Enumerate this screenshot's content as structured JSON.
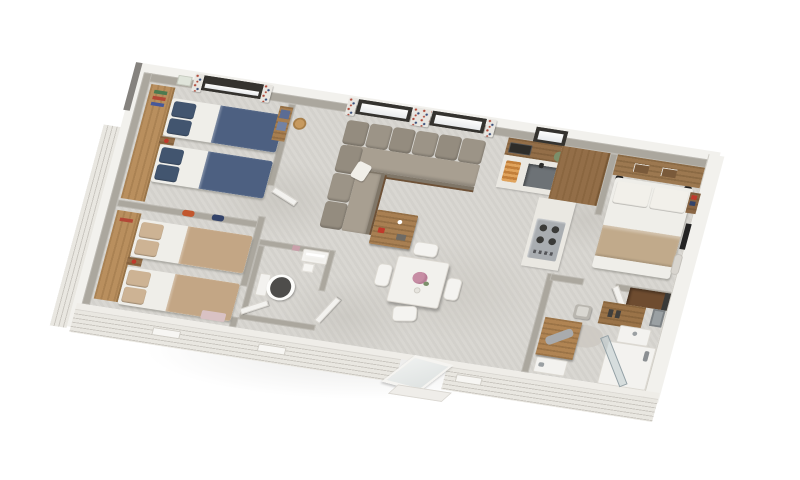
{
  "scene": {
    "kind": "3d-isometric-floor-plan-render",
    "subject": "mobile-home / holiday-home interior, three bedrooms",
    "background": "#ffffff",
    "visible_text": "none"
  },
  "palette": {
    "bg": "#ffffff",
    "floor": "#d7d5d0",
    "wall": "#aba79e",
    "fascia": "#f2f1ed",
    "siding_light": "#e9e7e1",
    "siding_dark": "#c9c6bf",
    "wood_light": "#b98f5e",
    "wood_mid": "#936e48",
    "wood_dark": "#6e4c30",
    "sofa_cushion": "#948c7f",
    "sofa_seat": "#a89f91",
    "navy": "#4d6081",
    "navy_dark": "#42556f",
    "sheet": "#efeee9",
    "tan": "#c3a685",
    "tan_light": "#cdb394",
    "throw": "#c1aa8b",
    "counter": "#eae8e2",
    "sink": "#6d7276",
    "cooktop": "#a9adb1",
    "whitefurn": "#f3f2ef",
    "frame_dark": "#35332f",
    "curtain": "#e8e6e1",
    "accent_red": "#c0392b",
    "accent_orange": "#c2572e",
    "accent_navy": "#33436a",
    "flower": "#c78da4",
    "leaf": "#7b8f6a",
    "seat_dark": "#4e4d4b",
    "glass": "#b9c7cc",
    "rug": "#ccc9c2"
  },
  "building": {
    "exterior": [
      "white-clapboard-siding",
      "vent-grilles-x3",
      "open-glazed-entrance-door",
      "entry-step"
    ],
    "rooms": [
      {
        "name": "bedroom-twin-1",
        "position": "top-left",
        "furniture": [
          "wardrobe",
          "twin-bed-navy",
          "twin-bed-navy",
          "nightstand",
          "window-with-blind",
          "floral-curtain",
          "wall-art",
          "shelf-with-blue-boxes"
        ]
      },
      {
        "name": "bedroom-twin-2",
        "position": "bottom-left",
        "furniture": [
          "wardrobe",
          "twin-bed-tan",
          "twin-bed-tan",
          "nightstand",
          "storage-box-pink"
        ]
      },
      {
        "name": "wc",
        "position": "center-left",
        "furniture": [
          "toilet",
          "towel-shelf",
          "wall-art"
        ]
      },
      {
        "name": "hallway",
        "position": "center",
        "furniture": [
          "pendant-lamp",
          "open-doors"
        ]
      },
      {
        "name": "living-room",
        "position": "center-top",
        "furniture": [
          "corner-sofa-taupe",
          "white-throw-pillow",
          "coffee-table",
          "window",
          "window",
          "floral-curtains"
        ]
      },
      {
        "name": "dining-area",
        "position": "center",
        "furniture": [
          "square-white-table",
          "chair",
          "chair",
          "chair",
          "chair",
          "pink-flower-vase"
        ]
      },
      {
        "name": "kitchen",
        "position": "center-right",
        "furniture": [
          "wall-cabinet",
          "microwave",
          "window",
          "counter",
          "sink-with-faucet",
          "cutting-board-food",
          "plant",
          "tall-cabinet",
          "gas-hob-peninsula"
        ]
      },
      {
        "name": "master-bedroom",
        "position": "right",
        "furniture": [
          "headboard-shelf",
          "double-bed",
          "reading-lamp",
          "reading-lamp",
          "nightstand",
          "tv",
          "hanging-garment"
        ]
      },
      {
        "name": "bathroom",
        "position": "bottom-right",
        "furniture": [
          "corner-shelf-dark-wood",
          "vanity-wood",
          "basin",
          "mirror",
          "stool-with-towel",
          "round-rug",
          "wood-desk",
          "gray-towel",
          "shower-tray",
          "corner-shower-glass",
          "towel-rail"
        ]
      }
    ]
  }
}
